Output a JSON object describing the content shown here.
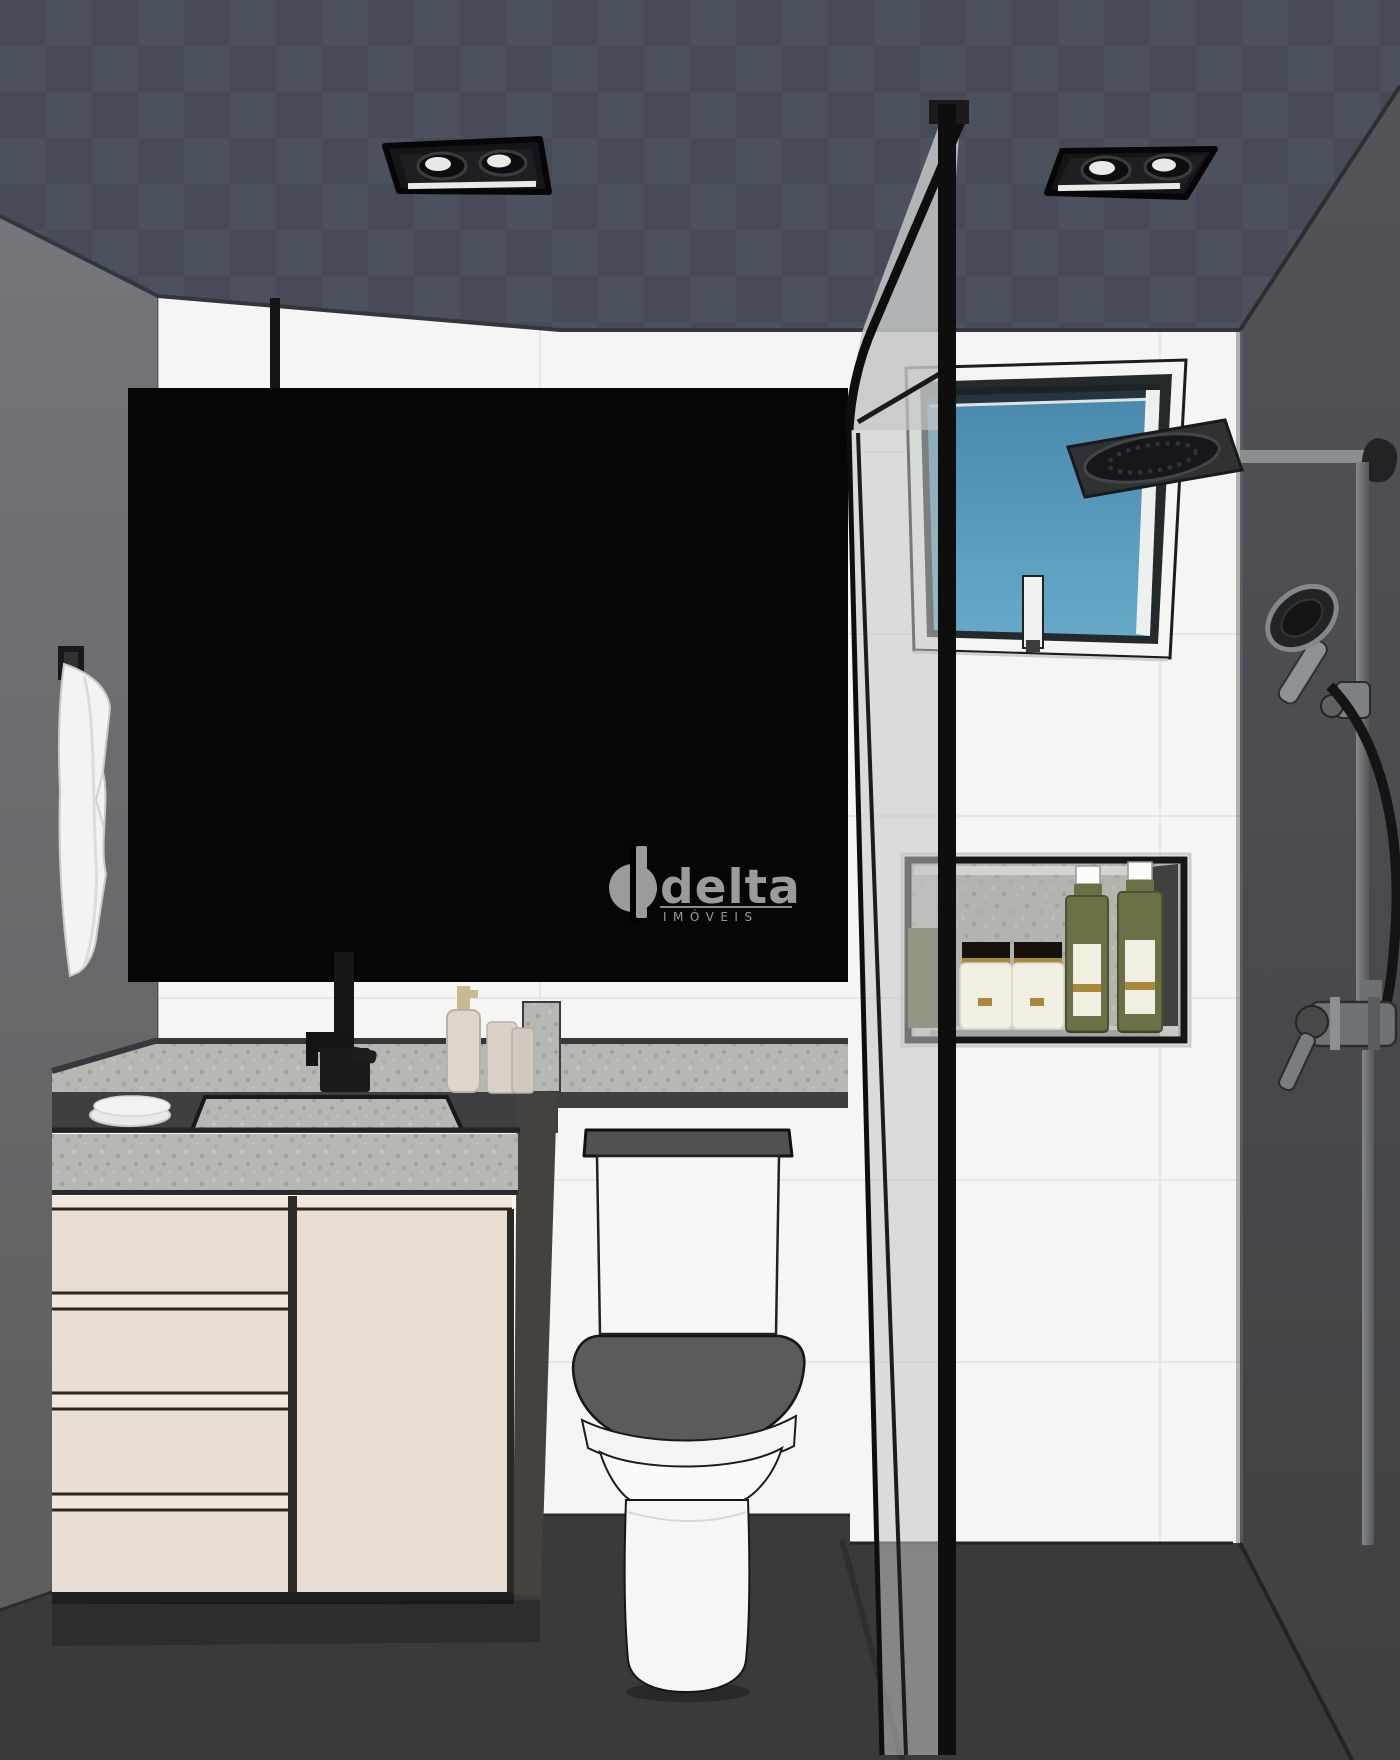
{
  "watermark": {
    "brand": "delta",
    "subtitle": "IMÓVEIS"
  },
  "colors": {
    "ceiling_a": "#4c515e",
    "ceiling_b": "#464b57",
    "wall_white": "#f5f5f4",
    "grout": "#e7e7e5",
    "left_wall": "#6a6b6c",
    "right_wall": "#4a4b4e",
    "floor": "#3a3a3b",
    "mirror_black": "#060606",
    "watermark_gray": "#9b9b9b",
    "frame_black": "#0e0e0f",
    "corner_band": "#c3c6c5",
    "counter_dark": "#3e3f40",
    "cabinet_cream": "#e9ded4",
    "cabinet_rail": "#f1e7dd",
    "side_panel": "#44413e",
    "toilet_white": "#f7f7f6",
    "seat_gray": "#5a5c5c",
    "tank_lid": "#4f5152",
    "towel_white": "#f3f3f1",
    "sky_top": "#4888ac",
    "sky_bottom": "#66aac8",
    "olive": "#6d7046",
    "gold": "#a8893c",
    "label_cream": "#f1eee2",
    "metal_gray": "#8b8e8f",
    "hose_black": "#141414",
    "light_glow": "#e9e9e6",
    "niche_shadow": "#3f413f"
  }
}
